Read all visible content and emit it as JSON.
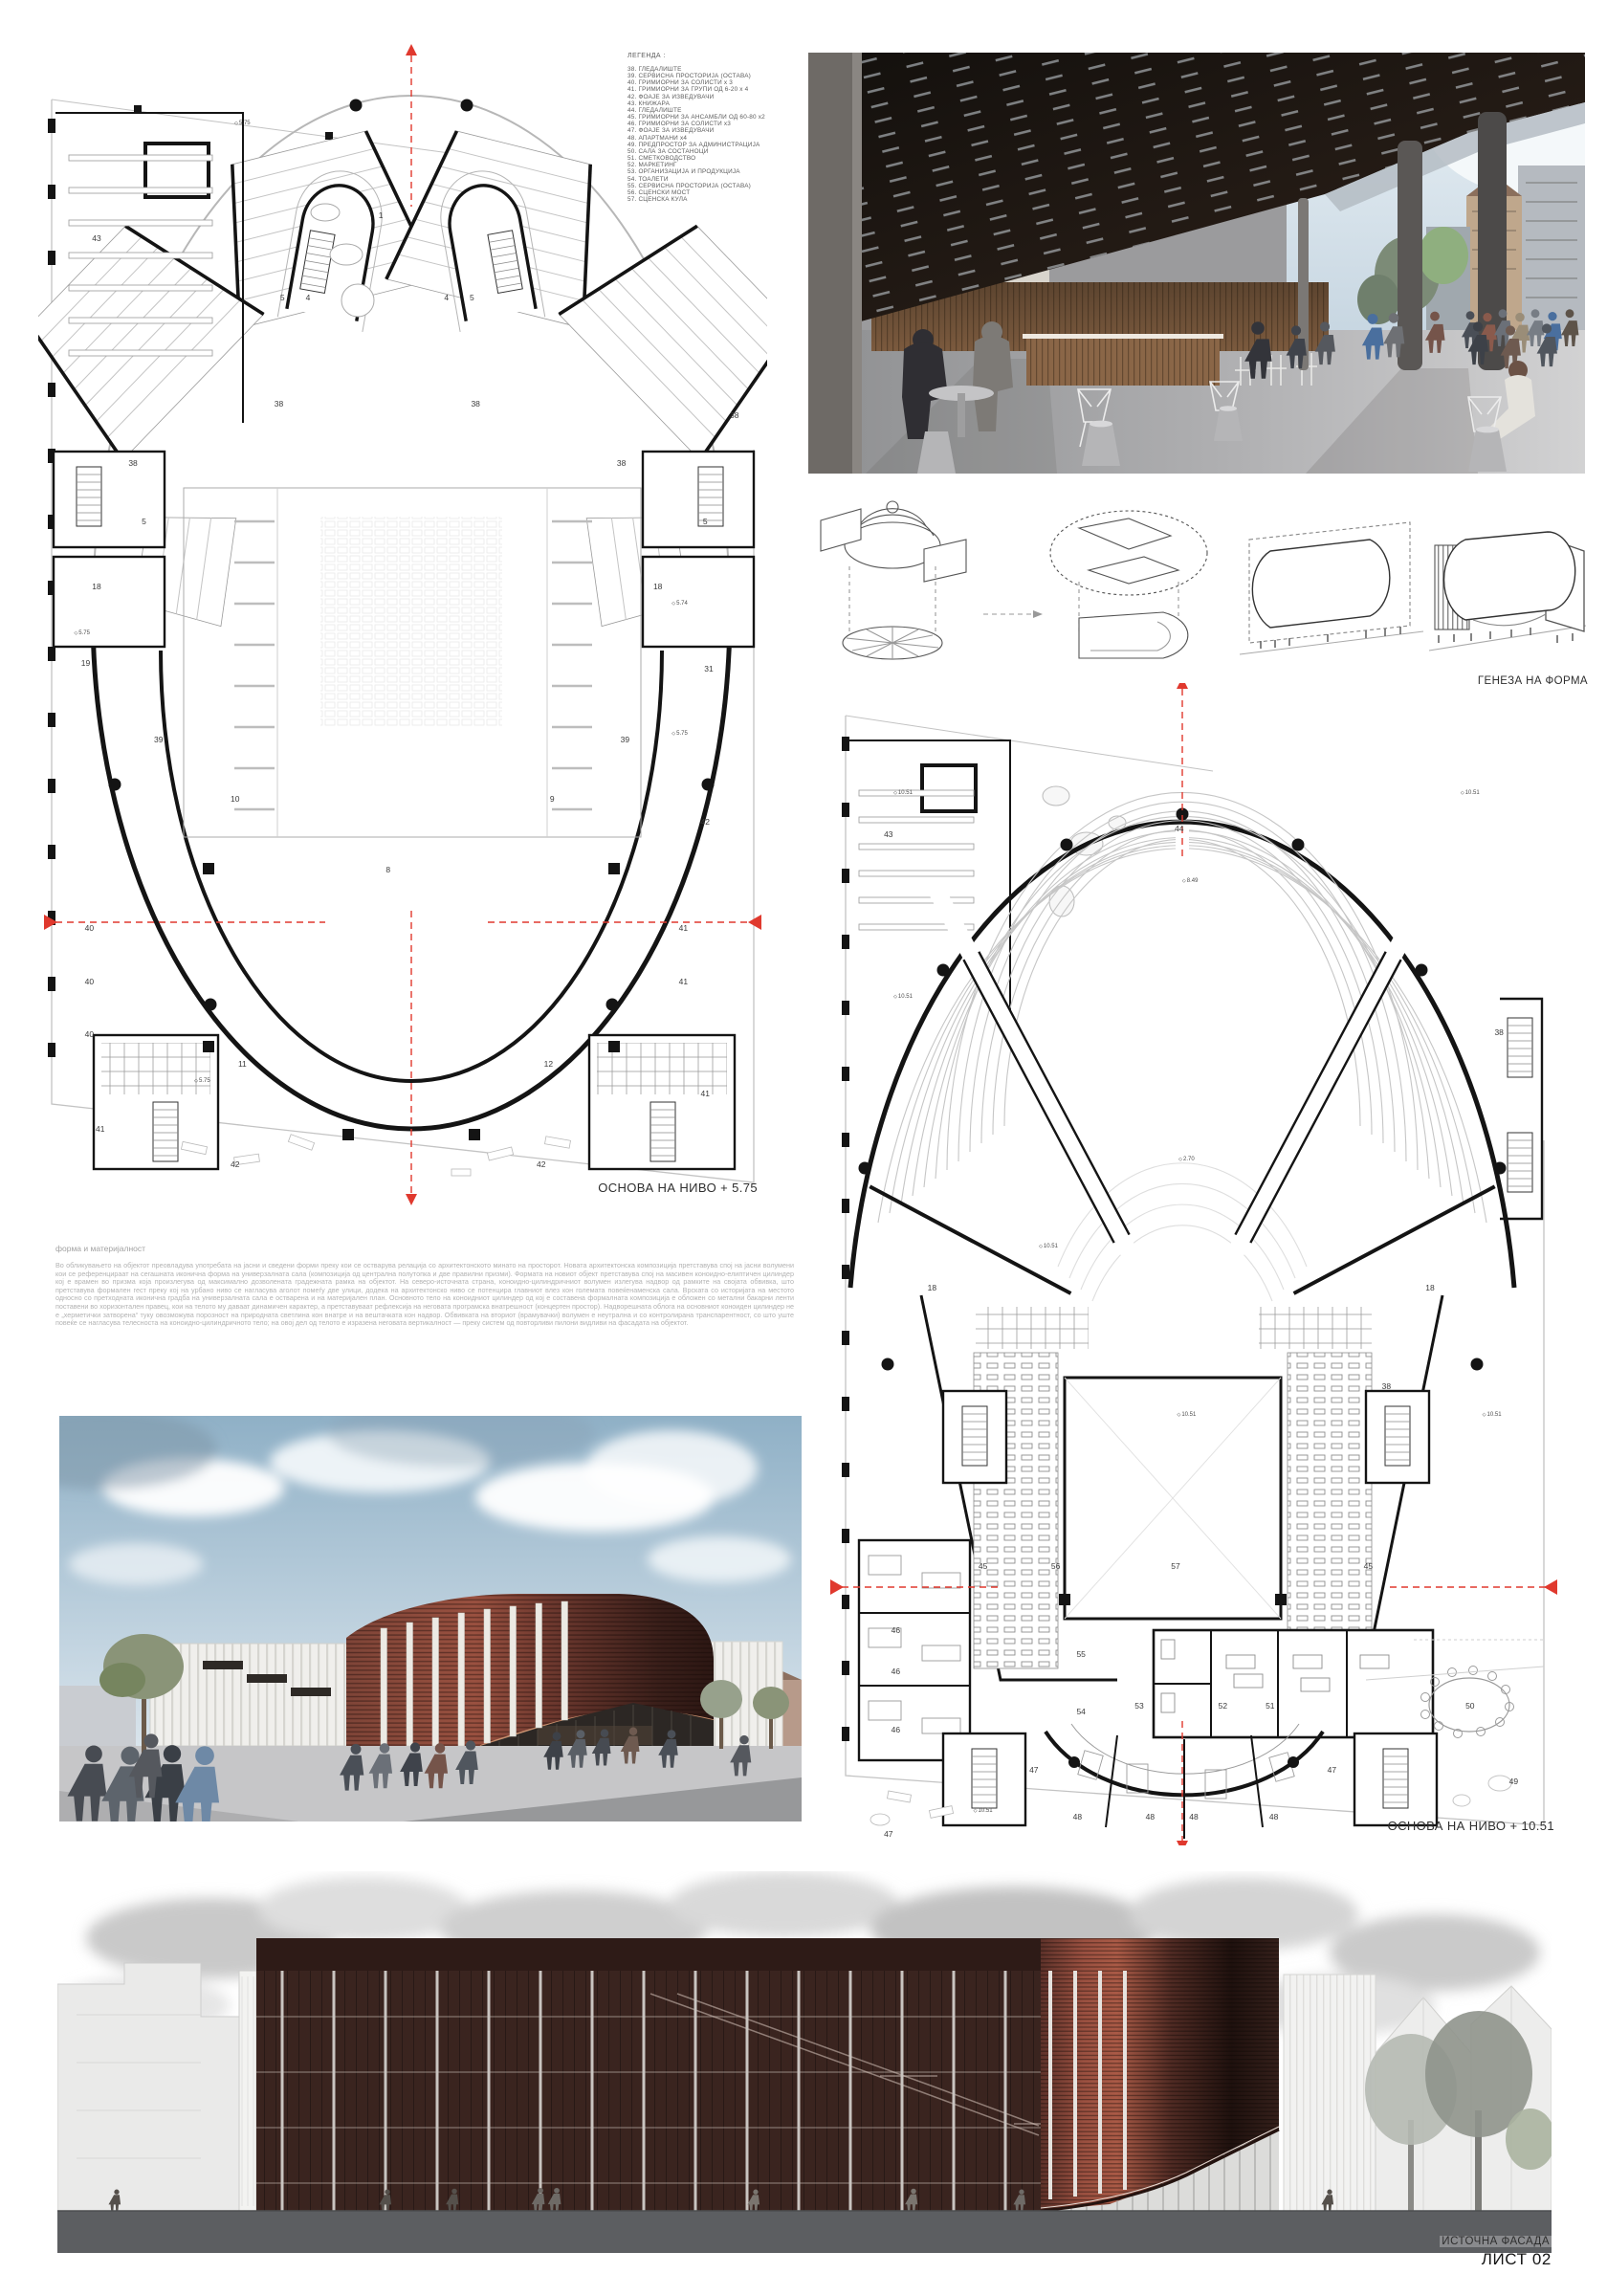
{
  "sheet": {
    "number_label": "ЛИСТ 02",
    "facade_label": "ИСТОЧНА ФАСАДА"
  },
  "legend": {
    "title": "ЛЕГЕНДА :",
    "items": [
      "38. ГЛЕДАЛИШТЕ",
      "39. СЕРВИСНА ПРОСТОРИЈА (ОСТАВА)",
      "40. ГРИМИОРНИ ЗА СОЛИСТИ x 3",
      "41. ГРИМИОРНИ ЗА ГРУПИ ОД 6-20 x 4",
      "42. ФОАЈЕ ЗА ИЗВЕДУВАЧИ",
      "43. КНИЖАРА",
      "44. ГЛЕДАЛИШТЕ",
      "45. ГРИМИОРНИ ЗА АНСАМБЛИ ОД 60-80 x2",
      "46. ГРИМИОРНИ ЗА СОЛИСТИ x3",
      "47. ФОАЈЕ ЗА ИЗВЕДУВАЧИ",
      "48. АПАРТМАНИ x4",
      "49. ПРЕДПРОСТОР ЗА АДМИНИСТРАЦИЈА",
      "50. САЛА ЗА СОСТАНОЦИ",
      "51. СМЕТКОВОДСТВО",
      "52. МАРКЕТИНГ",
      "53. ОРГАНИЗАЦИЈА И ПРОДУКЦИЈА",
      "54. ТОАЛЕТИ",
      "55. СЕРВИСНА ПРОСТОРИЈА (ОСТАВА)",
      "56. СЦЕНСКИ МОСТ",
      "57. СЦЕНСКА КУЛА"
    ]
  },
  "plans": {
    "level1": {
      "caption": "ОСНОВА НА НИВО + 5.75",
      "annotations": [
        {
          "t": "1",
          "x": 47,
          "y": 15
        },
        {
          "t": "43",
          "x": 8,
          "y": 17
        },
        {
          "t": "5",
          "x": 33.5,
          "y": 22
        },
        {
          "t": "4",
          "x": 37,
          "y": 22
        },
        {
          "t": "4",
          "x": 56,
          "y": 22
        },
        {
          "t": "5",
          "x": 59.5,
          "y": 22
        },
        {
          "t": "38",
          "x": 33,
          "y": 31
        },
        {
          "t": "38",
          "x": 60,
          "y": 31
        },
        {
          "t": "38",
          "x": 13,
          "y": 36
        },
        {
          "t": "38",
          "x": 80,
          "y": 36
        },
        {
          "t": "38",
          "x": 95.5,
          "y": 32
        },
        {
          "t": "5",
          "x": 14.5,
          "y": 41
        },
        {
          "t": "5",
          "x": 91.5,
          "y": 41
        },
        {
          "t": "18",
          "x": 8,
          "y": 46.5
        },
        {
          "t": "18",
          "x": 85,
          "y": 46.5
        },
        {
          "t": "19",
          "x": 6.5,
          "y": 53
        },
        {
          "t": "31",
          "x": 92,
          "y": 53.5
        },
        {
          "t": "39",
          "x": 16.5,
          "y": 59.5
        },
        {
          "t": "39",
          "x": 80.5,
          "y": 59.5
        },
        {
          "t": "10",
          "x": 27,
          "y": 64.5
        },
        {
          "t": "9",
          "x": 70.5,
          "y": 64.5
        },
        {
          "t": "8",
          "x": 48,
          "y": 70.5
        },
        {
          "t": "42",
          "x": 91.5,
          "y": 66.5
        },
        {
          "t": "40",
          "x": 7,
          "y": 75.5
        },
        {
          "t": "40",
          "x": 7,
          "y": 80
        },
        {
          "t": "40",
          "x": 7,
          "y": 84.5
        },
        {
          "t": "41",
          "x": 88.5,
          "y": 75.5
        },
        {
          "t": "41",
          "x": 88.5,
          "y": 80
        },
        {
          "t": "41",
          "x": 91.5,
          "y": 89.5
        },
        {
          "t": "41",
          "x": 8.5,
          "y": 92.5
        },
        {
          "t": "11",
          "x": 28,
          "y": 87
        },
        {
          "t": "12",
          "x": 70,
          "y": 87
        },
        {
          "t": "42",
          "x": 27,
          "y": 95.5
        },
        {
          "t": "42",
          "x": 69,
          "y": 95.5
        },
        {
          "t": "5.75",
          "x": 28,
          "y": 7.2,
          "c": "lvl"
        },
        {
          "t": "5.75",
          "x": 6,
          "y": 50.5,
          "c": "lvl"
        },
        {
          "t": "5.74",
          "x": 88,
          "y": 48,
          "c": "lvl"
        },
        {
          "t": "5.75",
          "x": 22.5,
          "y": 88.5,
          "c": "lvl"
        },
        {
          "t": "5.75",
          "x": 88,
          "y": 59,
          "c": "lvl"
        }
      ]
    },
    "level2": {
      "caption": "ОСНОВА НА НИВО + 10.51",
      "annotations": [
        {
          "t": "43",
          "x": 8,
          "y": 13
        },
        {
          "t": "44",
          "x": 48,
          "y": 12.5
        },
        {
          "t": "38",
          "x": 92,
          "y": 30
        },
        {
          "t": "38",
          "x": 76.5,
          "y": 60.5
        },
        {
          "t": "18",
          "x": 14,
          "y": 52
        },
        {
          "t": "18",
          "x": 82.5,
          "y": 52
        },
        {
          "t": "45",
          "x": 21,
          "y": 76
        },
        {
          "t": "56",
          "x": 31,
          "y": 76
        },
        {
          "t": "57",
          "x": 47.5,
          "y": 76
        },
        {
          "t": "45",
          "x": 74,
          "y": 76
        },
        {
          "t": "46",
          "x": 9,
          "y": 81.5
        },
        {
          "t": "46",
          "x": 9,
          "y": 85
        },
        {
          "t": "46",
          "x": 9,
          "y": 90
        },
        {
          "t": "55",
          "x": 34.5,
          "y": 83.5
        },
        {
          "t": "54",
          "x": 34.5,
          "y": 88.5
        },
        {
          "t": "53",
          "x": 42.5,
          "y": 88
        },
        {
          "t": "52",
          "x": 54,
          "y": 88
        },
        {
          "t": "51",
          "x": 60.5,
          "y": 88
        },
        {
          "t": "50",
          "x": 88,
          "y": 88
        },
        {
          "t": "47",
          "x": 28,
          "y": 93.5
        },
        {
          "t": "47",
          "x": 69,
          "y": 93.5
        },
        {
          "t": "47",
          "x": 8,
          "y": 99
        },
        {
          "t": "48",
          "x": 34,
          "y": 97.5
        },
        {
          "t": "48",
          "x": 44,
          "y": 97.5
        },
        {
          "t": "48",
          "x": 50,
          "y": 97.5
        },
        {
          "t": "48",
          "x": 61,
          "y": 97.5
        },
        {
          "t": "49",
          "x": 94,
          "y": 94.5
        },
        {
          "t": "10.51",
          "x": 10,
          "y": 9.5,
          "c": "lvl"
        },
        {
          "t": "10.51",
          "x": 88,
          "y": 9.5,
          "c": "lvl"
        },
        {
          "t": "8.49",
          "x": 49.5,
          "y": 17,
          "c": "lvl"
        },
        {
          "t": "2.70",
          "x": 49,
          "y": 41,
          "c": "lvl"
        },
        {
          "t": "10.51",
          "x": 10,
          "y": 27,
          "c": "lvl"
        },
        {
          "t": "10.51",
          "x": 30,
          "y": 48.5,
          "c": "lvl"
        },
        {
          "t": "10.51",
          "x": 49,
          "y": 63,
          "c": "lvl"
        },
        {
          "t": "10.51",
          "x": 91,
          "y": 63,
          "c": "lvl"
        },
        {
          "t": "10.51",
          "x": 21,
          "y": 97,
          "c": "lvl"
        }
      ]
    }
  },
  "genesis": {
    "caption": "ГЕНЕЗА НА ФОРМА"
  },
  "essay": {
    "title": "форма и материјалност",
    "body": "Во обликувањето на објектот преовладува употребата на јасни и сведени форми преку кои се остварува релација со архитектонското минато на просторот. Новата архитектонска композиција претставува спој на јасни волумени кои се референцираат на сегашната иконична форма на универзалната сала (композиција од централна полутопка и две правилни призми). Формата на новиот објект претставува спој на масивен коноидно-елиптичен цилиндер кој е врамен во призма која произлегува од максимално дозволената градежната рамка на објектот. На северо-источната страна, коноидно-цилиндричниот волумен излегува надвор од рамките на својата обвивка, што претставува формален гест преку кој на урбано ниво се нагласува аголот помеѓу две улици, додека на архитектонско ниво се потенцира главниот влез кон големата повеќенаменска сала. Врската со историјата на местото односно со претходната иконична градба на универзалната сала е остварена и на материјален план. Основното тело на коноидниот цилиндер од кој е составена формалната композиција е обложен со метални бакарни ленти поставени во хоризонтален правец, кои на телото му даваат динамичен карактер, а претставуваат рефлексија на неговата програмска внатрешност (концертен простор). Надворешната облога на основниот коноиден цилиндер не е „херметички затворена“ туку овозможува порозност на природната светлина кон внатре и на вештачката кон надвор. Обвивката на вториот (врамувачки) волумен е неутрална и со контролирана транспарентност, со што уште повеќе се нагласува телесноста на коноидно-цилиндричното тело; на овој дел од телото е изразена неговата вертикалност — преку систем од повторливи пилони видливи на фасадата на објектот."
  },
  "colors": {
    "copper": "#6b3a33",
    "copper_highlight": "#a65a47",
    "copper_dark": "#241512",
    "section_red": "#e0392e",
    "elevation_ground": "#5c5e61",
    "plan_line": "#141414"
  }
}
